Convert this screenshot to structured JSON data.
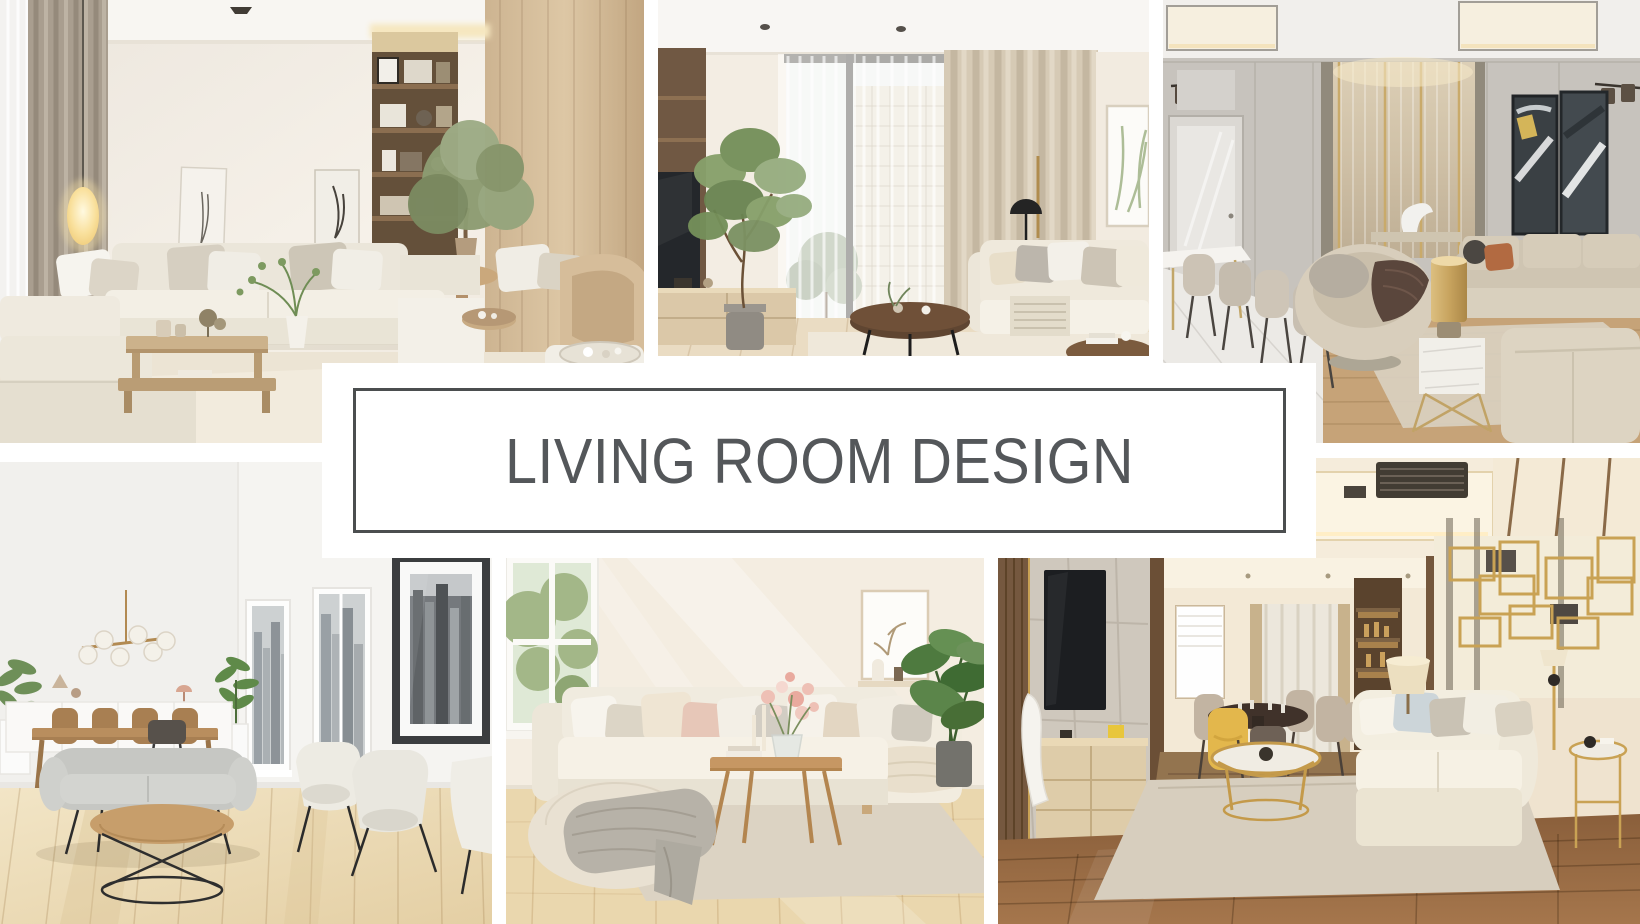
{
  "page": {
    "background_color": "#ffffff",
    "kind": "interior design photo collage"
  },
  "banner": {
    "title": "LIVING ROOM DESIGN",
    "text_color": "#54575a",
    "border_color": "#4b4e4f",
    "background_color": "#ffffff"
  },
  "photos": [
    {
      "id": "top-left",
      "description": "Bright cream living room with L-shaped sectional sofa, glowing oval pendant lamp, taupe curtains, wooden shelf niche with books, potted tree and low wooden coffee table"
    },
    {
      "id": "top-middle",
      "description": "Living room with tall window and sheer curtains, beige drapes, dark TV on wooden media wall, potted ficus tree, round walnut coffee table and light sofa with pillows"
    },
    {
      "id": "top-right",
      "description": "Luxury greige lounge with slatted feature wall and gold trim, dark abstract wall art, beige sofas, curved swivel chair with brown throw, gold lamp on marble side table and dining corner"
    },
    {
      "id": "bottom-left",
      "description": "White Scandinavian room with gray loveseat, cream armchairs, round wood coffee table on black wire base, dining table, brass globe chandelier, city-view windows and framed skyline photo"
    },
    {
      "id": "bottom-middle",
      "description": "Sunlit cream sectional sofa with blush and beige pillows, wooden coffee table with flower vase, pouf draped with gray blanket, garden window and green plant"
    },
    {
      "id": "bottom-right",
      "description": "Warm modern living-dining room with marble TV wall, light wood console, round brass coffee table, cream sofa, gold geometric wall art, yellow dining chair and dark wood floor"
    }
  ]
}
